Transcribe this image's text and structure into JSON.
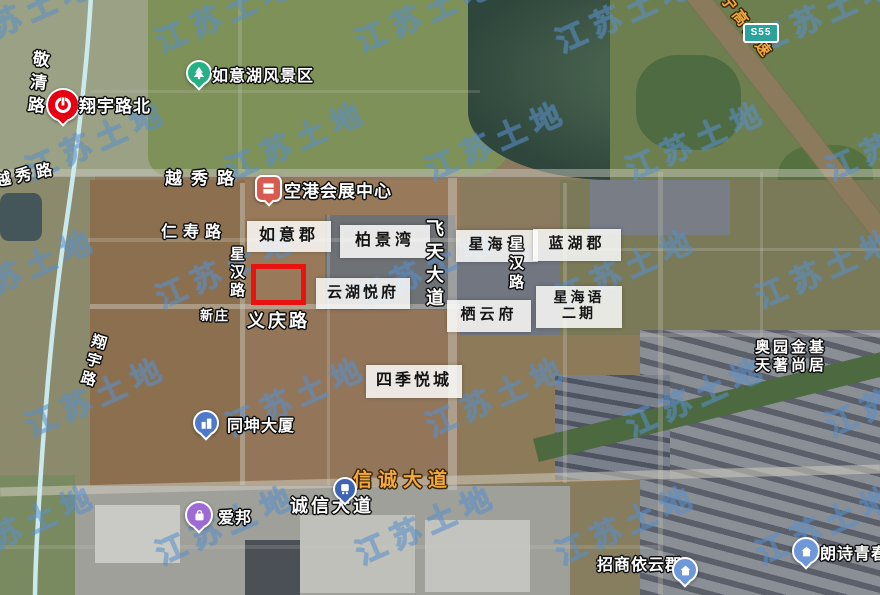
{
  "map": {
    "watermark": "江苏土地",
    "expressway_badge": "S55",
    "highlight_color": "#ea1111"
  },
  "roads": {
    "jingqinglu": "敬清路",
    "yuexiulu_left": "越秀路",
    "yuexiulu": "越秀路",
    "renshoulu": "仁寿路",
    "xinghanlu_west": "星汉路",
    "xinghanlu_east": "星汉路",
    "yiqinglu": "义庆路",
    "feitiandadao": "飞天大道",
    "xiangyulu": "翔宇路",
    "xinchengdadao": "信诚大道",
    "chengxindadao": "诚信大道",
    "expressway": "宁高高速"
  },
  "stations": {
    "xiangyulubei": "翔宇路北"
  },
  "pois": {
    "ruyihu_scenic": "如意湖风景区",
    "konggang_expo": "空港会展中心",
    "xinzhuang": "新庄",
    "tongkun_tower": "同坤大厦",
    "aibang": "爱邦",
    "zhaoshang_yiyunjun": "招商依云郡",
    "langshi_qingchun": "朗诗青春街"
  },
  "estates": {
    "ruyijun": "如意郡",
    "bojingwan": "柏景湾",
    "xinghaiyu": "星海语",
    "lanhujun": "蓝湖郡",
    "yunhu_yuefu": "云湖悦府",
    "qiyunfu": "栖云府",
    "xinghaiyu_phase2_l1": "星海语",
    "xinghaiyu_phase2_l2": "二期",
    "siji_yuecheng": "四季悦城",
    "aoyuan_l1": "奥园金基",
    "aoyuan_l2": "天著尚居"
  }
}
